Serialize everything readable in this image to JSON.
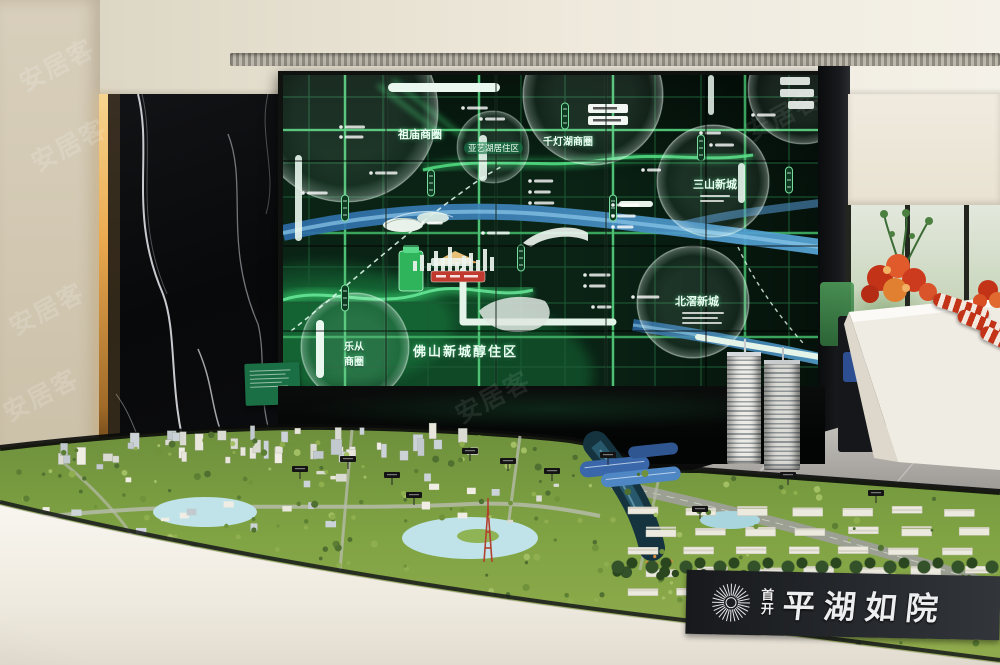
{
  "watermark": {
    "text": "安居客"
  },
  "screen": {
    "labels": {
      "zumiao": "祖庙商圈",
      "qiandenghu": "千灯湖商圈",
      "yayihu": "亚艺湖居住区",
      "sanshan": "三山新城",
      "beijiao": "北滘新城",
      "lecong_top": "乐从",
      "lecong_bottom": "商圈",
      "foshan_new_town": "佛山新城醇住区",
      "north": "北"
    },
    "colors": {
      "map_background": "#0a2315",
      "road_green": "#3fae63",
      "river_blue": "#4a9fd8",
      "highlight_red": "#c03a30"
    }
  },
  "model": {
    "logo": {
      "brand_char_top": "首",
      "brand_char_bottom": "开",
      "project_name": "平湖如院"
    },
    "colors": {
      "terrain_green": "#7fa343",
      "rim_white": "#f6f3ec"
    }
  }
}
